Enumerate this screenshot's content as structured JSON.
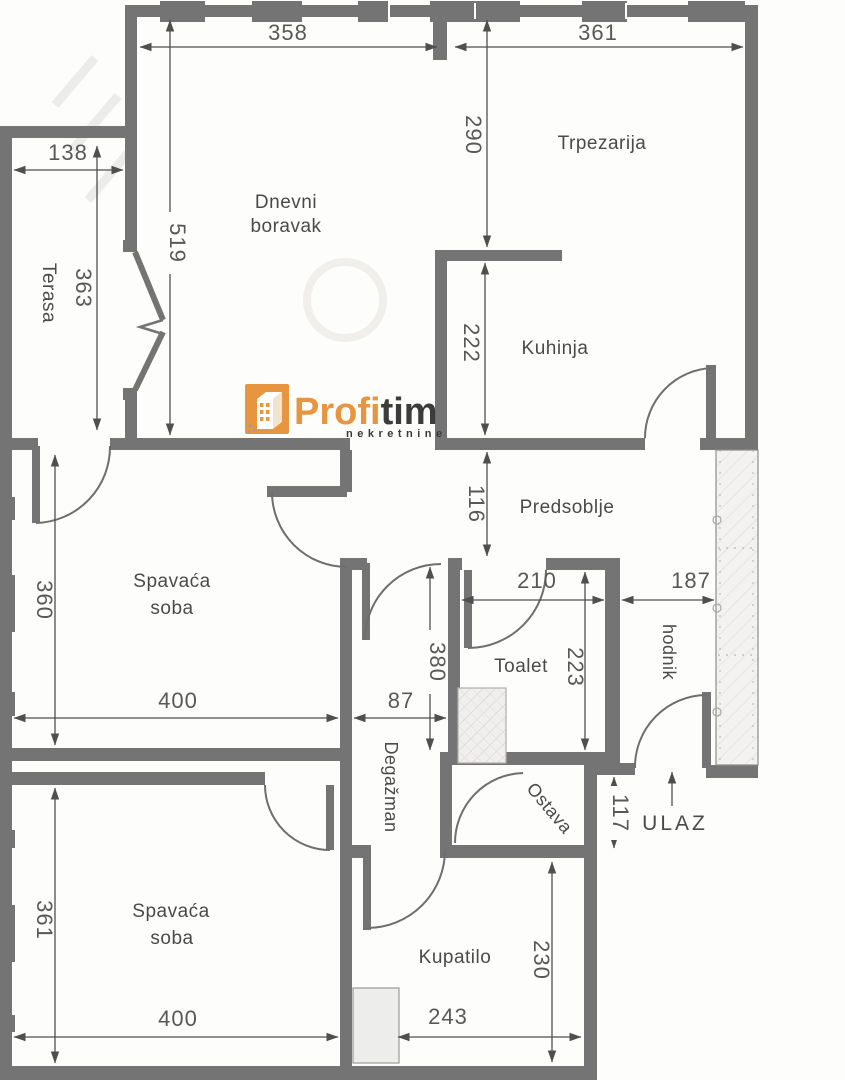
{
  "logo": {
    "brand_part1": "Profi",
    "brand_part2": "tim",
    "subtitle": "nekretnine",
    "accent_orange": "#e8953f",
    "dark": "#3c3c3c"
  },
  "rooms": {
    "terasa": "Terasa",
    "dnevni_line1": "Dnevni",
    "dnevni_line2": "boravak",
    "trpezarija": "Trpezarija",
    "kuhinja": "Kuhinja",
    "predsoblje": "Predsoblje",
    "spavaca1_line1": "Spavaća",
    "spavaca1_line2": "soba",
    "toalet": "Toalet",
    "hodnik": "hodnik",
    "degazman": "Degažman",
    "ostava": "Ostava",
    "spavaca2_line1": "Spavaća",
    "spavaca2_line2": "soba",
    "kupatilo": "Kupatilo",
    "ulaz": "ULAZ"
  },
  "dimensions": {
    "top_left_w": "358",
    "top_right_w": "361",
    "trpezarija_h": "290",
    "living_h": "519",
    "terasa_w": "138",
    "terasa_h": "363",
    "kuhinja_h": "222",
    "predsoblje_h": "116",
    "toalet_w": "210",
    "hodnik_w": "187",
    "toalet_h": "223",
    "bedroom1_h": "360",
    "bedroom1_w": "400",
    "degazman_w": "87",
    "degazman_h": "380",
    "ulaz_gap_h": "117",
    "bedroom2_h": "361",
    "bedroom2_w": "400",
    "kupatilo_w": "243",
    "kupatilo_h": "230"
  },
  "colors": {
    "wall": "#747474",
    "dim_line": "#4f4f4f",
    "text": "#4a4a4a",
    "glass_fill": "#f3f2f0"
  }
}
